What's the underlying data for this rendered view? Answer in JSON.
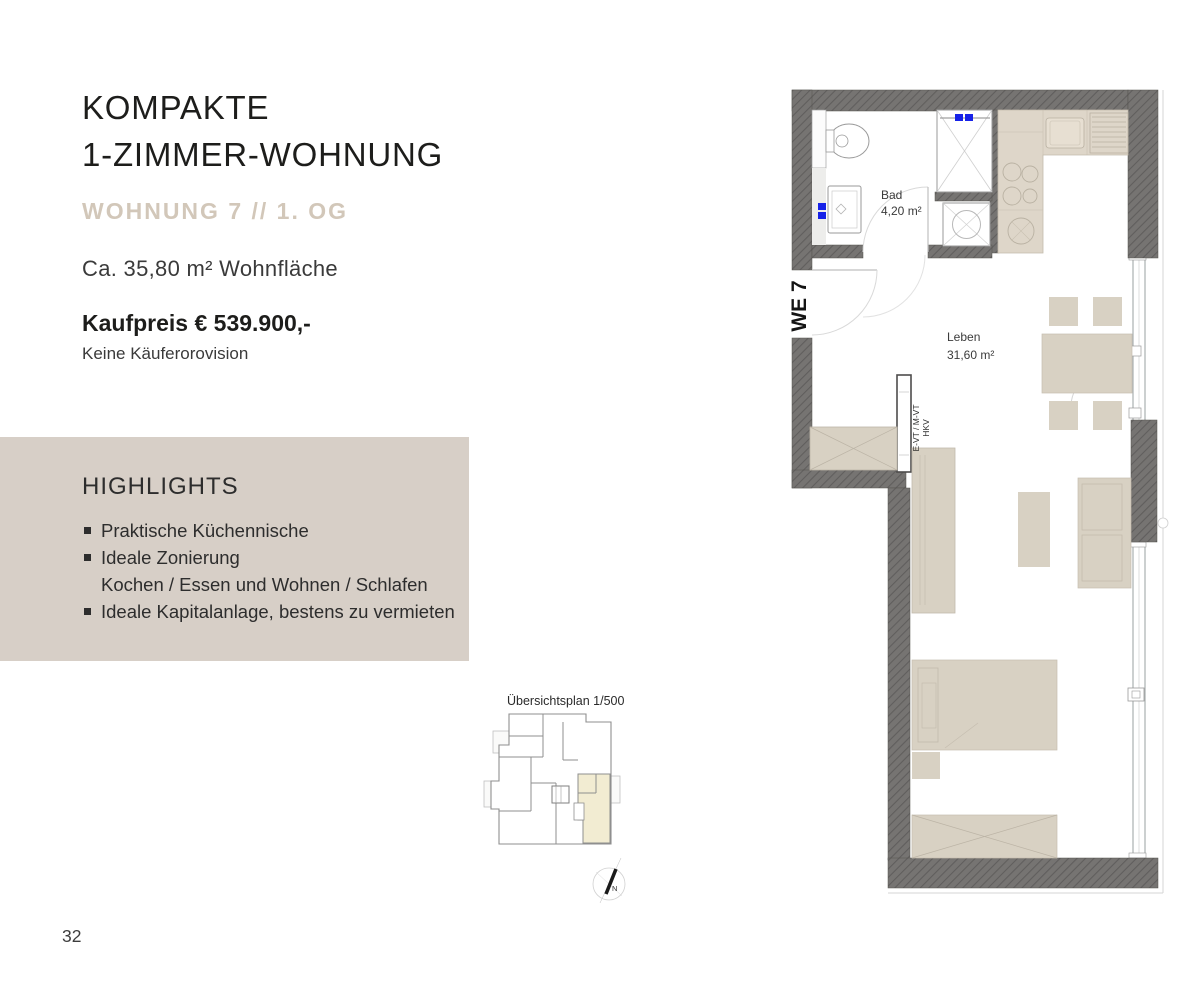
{
  "listing": {
    "title_line1": "KOMPAKTE",
    "title_line2": "1-ZIMMER-WOHNUNG",
    "subtitle": "WOHNUNG 7 // 1. OG",
    "area": "Ca. 35,80 m² Wohnfläche",
    "price": "Kaufpreis € 539.900,-",
    "provision_note": "Keine Käuferorovision"
  },
  "highlights": {
    "heading": "HIGHLIGHTS",
    "items": [
      {
        "label": "Praktische Küchennische",
        "sub": ""
      },
      {
        "label": "Ideale Zonierung",
        "sub": "Kochen / Essen und Wohnen / Schlafen"
      },
      {
        "label": "Ideale Kapitalanlage, bestens zu vermieten",
        "sub": ""
      }
    ]
  },
  "floorplan": {
    "unit_label": "WE 7",
    "rooms": [
      {
        "name": "Bad",
        "area": "4,20 m²"
      },
      {
        "name": "Leben",
        "area": "31,60 m²"
      }
    ],
    "shaft_label_line1": "E-VT / M-VT",
    "shaft_label_line2": "HKV"
  },
  "overview": {
    "label": "Übersichtsplan 1/500",
    "compass_letter": "N"
  },
  "page": {
    "number": "32"
  },
  "colors": {
    "accent_tan": "#d2c7b9",
    "highlight_box_bg": "#d7cfc7",
    "wall_gray": "#767472",
    "furniture_beige": "#d8d1c3",
    "kitchen_beige": "#ded6c9",
    "unit_highlight_yellow": "#f2ecd2",
    "fixture_blue": "#1722e8"
  }
}
